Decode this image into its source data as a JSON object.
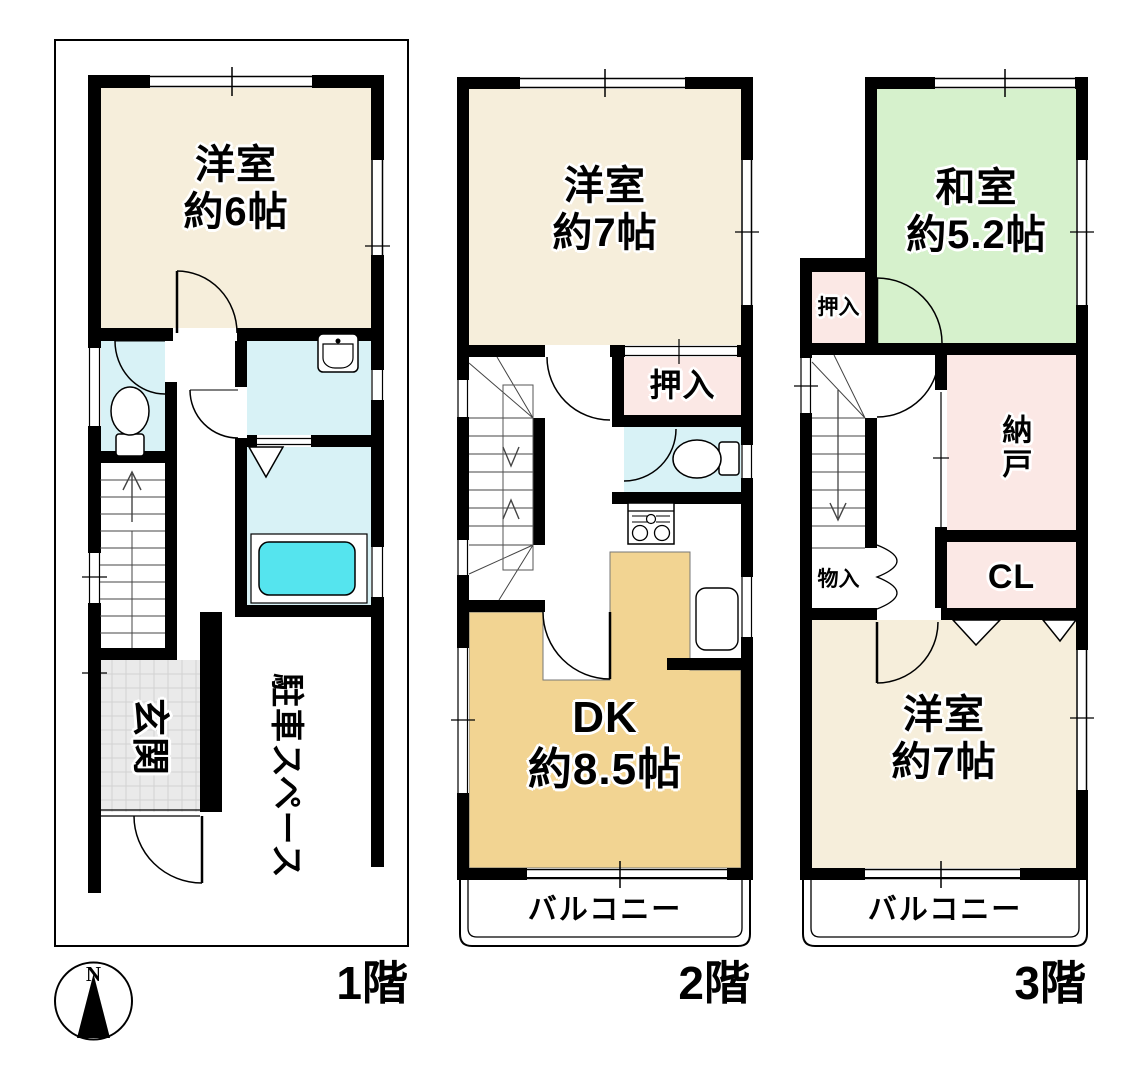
{
  "document": {
    "type": "floor-plan"
  },
  "compass": {
    "label": "N"
  },
  "floors": [
    {
      "label": "1階",
      "rooms": [
        {
          "name": "洋室",
          "size": "約6帖"
        },
        {
          "name": "玄関"
        },
        {
          "name": "駐車スペース"
        }
      ]
    },
    {
      "label": "2階",
      "rooms": [
        {
          "name": "洋室",
          "size": "約7帖"
        },
        {
          "name": "押入"
        },
        {
          "name": "DK",
          "size": "約8.5帖"
        },
        {
          "name": "バルコニー"
        }
      ]
    },
    {
      "label": "3階",
      "rooms": [
        {
          "name": "和室",
          "size": "約5.2帖"
        },
        {
          "name": "押入"
        },
        {
          "name": "納戸"
        },
        {
          "name": "CL"
        },
        {
          "name": "物入"
        },
        {
          "name": "洋室",
          "size": "約7帖"
        },
        {
          "name": "バルコニー"
        }
      ]
    }
  ],
  "colors": {
    "western_room": "#F6EEDB",
    "japanese_room": "#D6F1CC",
    "dining_kitchen": "#F2D492",
    "closet_pink": "#FBE8E5",
    "wet_area_cyan": "#D8F2F6",
    "bathtub": "#55E4EE",
    "entrance_gray": "#EAEAEA",
    "wall": "#000000"
  }
}
